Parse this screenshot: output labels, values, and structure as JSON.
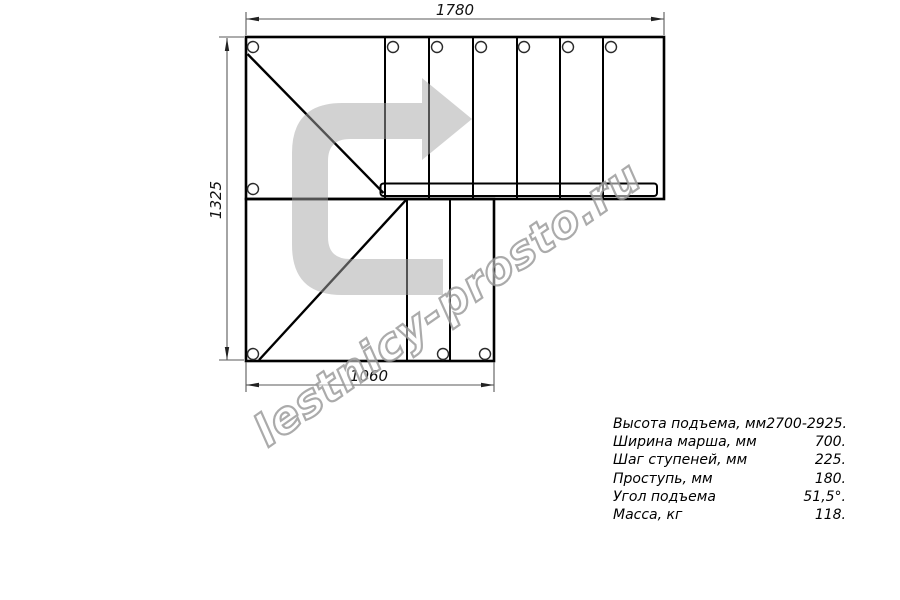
{
  "drawing": {
    "type": "stair-plan-top-view",
    "dimensions": {
      "top_width_mm": "1780",
      "left_height_mm": "1325",
      "bottom_width_mm": "1060"
    },
    "direction_arrow": {
      "icon": "u-turn-right-arrow",
      "color": "#d4d4d4"
    },
    "line_color": "#000000"
  },
  "watermark": {
    "text": "lestnicy-prosto.ru"
  },
  "specs": {
    "rows": [
      {
        "label": "Высота подъема, мм",
        "value": "2700-2925."
      },
      {
        "label": "Ширина марша, мм",
        "value": "700."
      },
      {
        "label": "Шаг ступеней, мм",
        "value": "225."
      },
      {
        "label": "Проступь, мм",
        "value": "180."
      },
      {
        "label": "Угол подъема",
        "value": "51,5°."
      },
      {
        "label": "Масса, кг",
        "value": "118."
      }
    ]
  }
}
